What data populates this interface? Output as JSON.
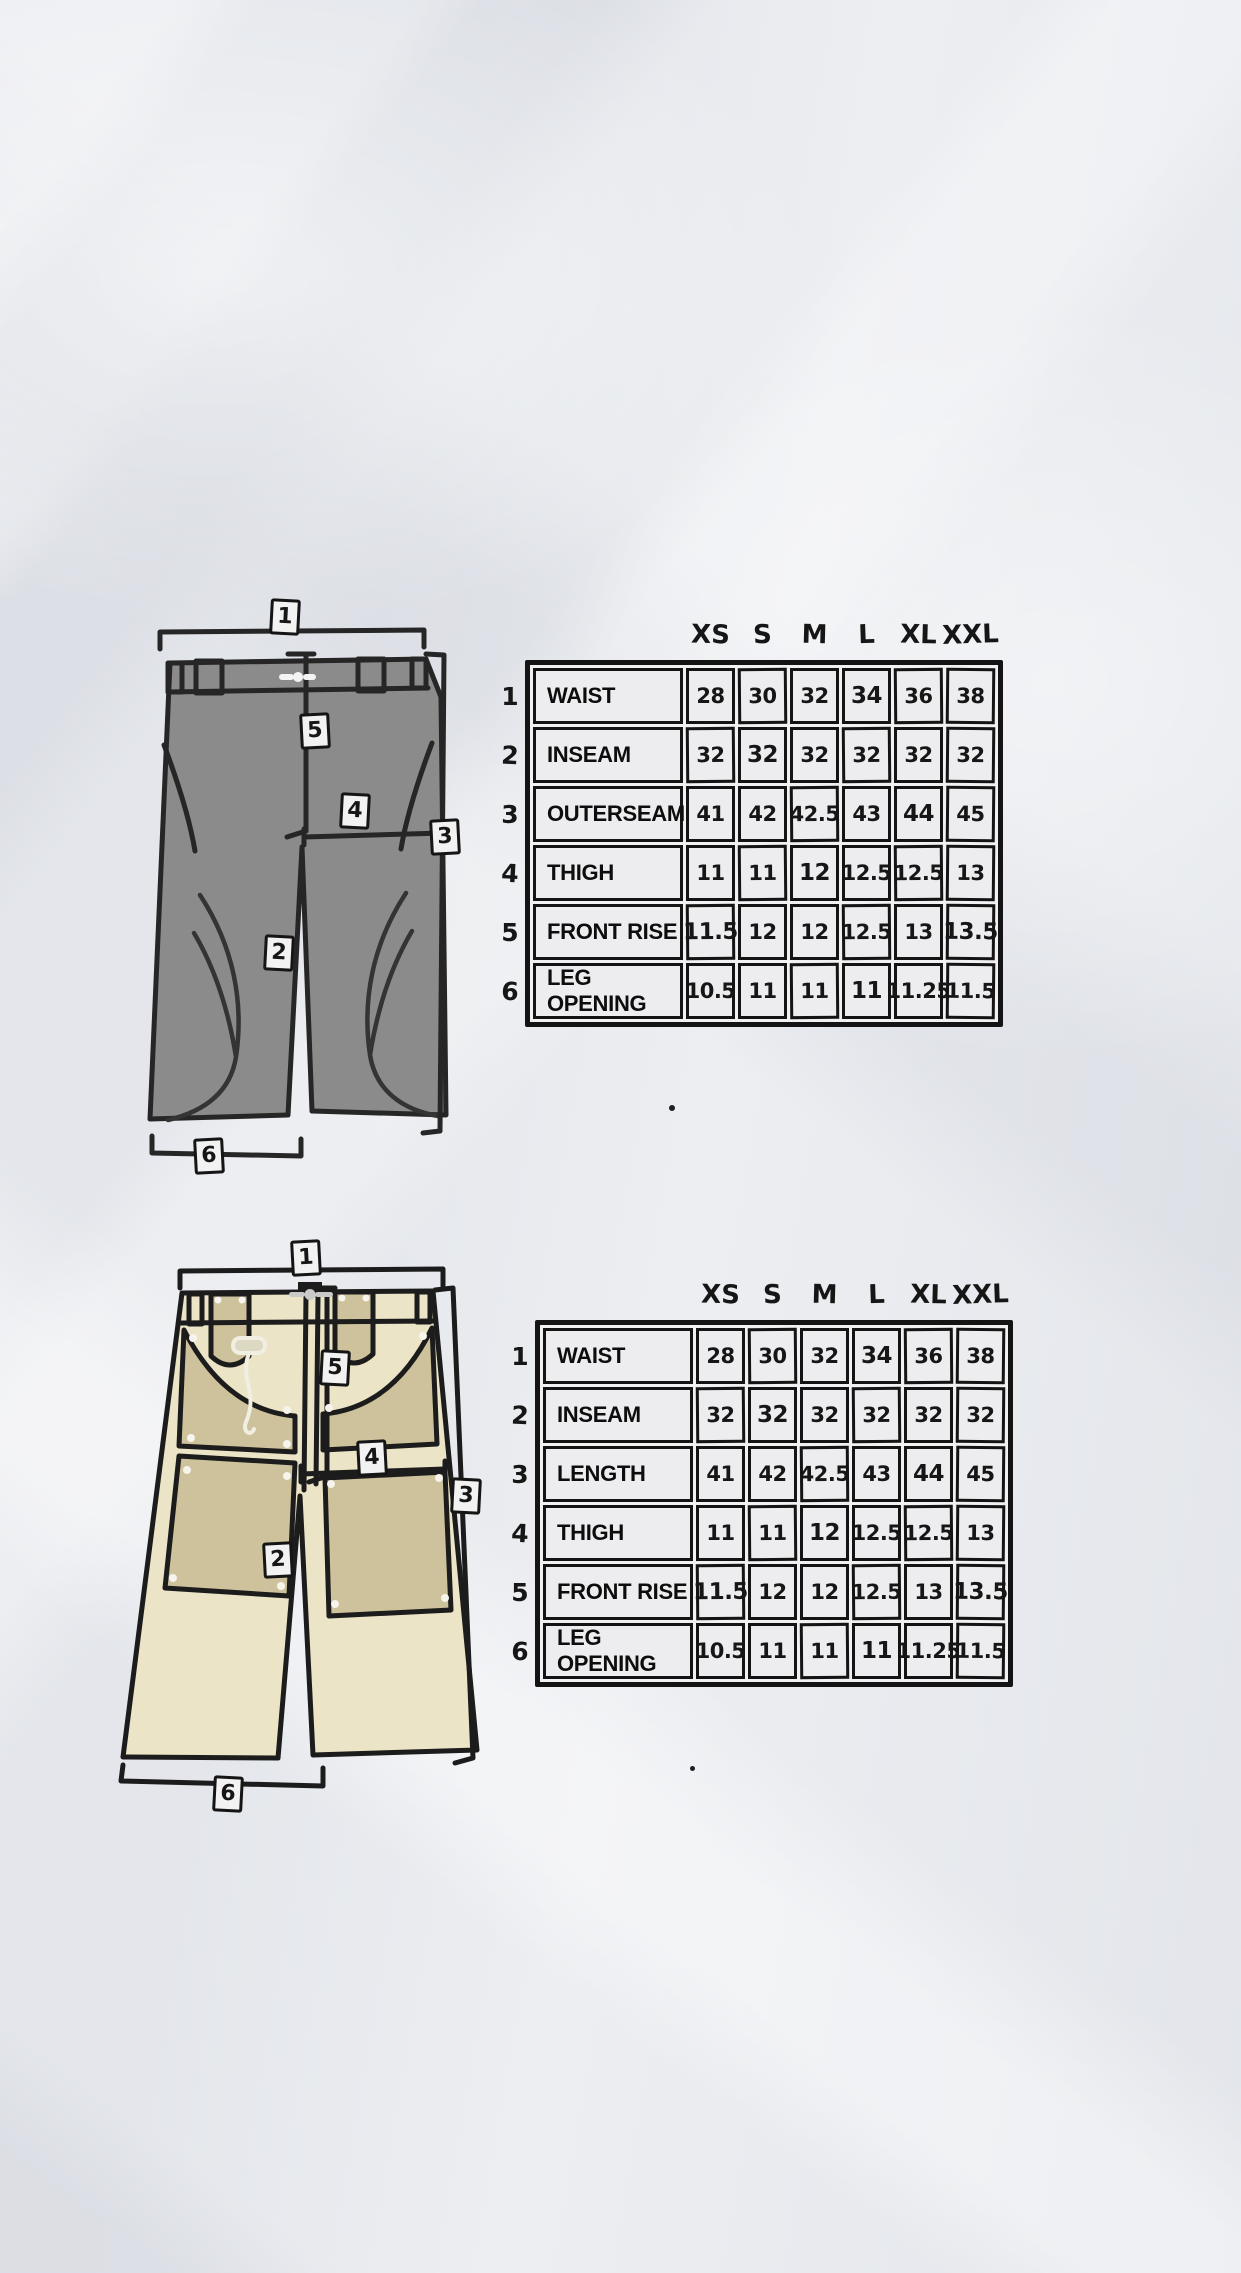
{
  "sizes": [
    "XS",
    "S",
    "M",
    "L",
    "XL",
    "XXL"
  ],
  "tables": [
    {
      "rows": [
        {
          "num": "1",
          "label": "WAIST",
          "values": [
            "28",
            "30",
            "32",
            "34",
            "36",
            "38"
          ]
        },
        {
          "num": "2",
          "label": "INSEAM",
          "values": [
            "32",
            "32",
            "32",
            "32",
            "32",
            "32"
          ]
        },
        {
          "num": "3",
          "label": "OUTERSEAM",
          "values": [
            "41",
            "42",
            "42.5",
            "43",
            "44",
            "45"
          ]
        },
        {
          "num": "4",
          "label": "THIGH",
          "values": [
            "11",
            "11",
            "12",
            "12.5",
            "12.5",
            "13"
          ]
        },
        {
          "num": "5",
          "label": "FRONT RISE",
          "values": [
            "11.5",
            "12",
            "12",
            "12.5",
            "13",
            "13.5"
          ]
        },
        {
          "num": "6",
          "label": "LEG OPENING",
          "values": [
            "10.5",
            "11",
            "11",
            "11",
            "11.25",
            "11.5"
          ]
        }
      ]
    },
    {
      "rows": [
        {
          "num": "1",
          "label": "WAIST",
          "values": [
            "28",
            "30",
            "32",
            "34",
            "36",
            "38"
          ]
        },
        {
          "num": "2",
          "label": "INSEAM",
          "values": [
            "32",
            "32",
            "32",
            "32",
            "32",
            "32"
          ]
        },
        {
          "num": "3",
          "label": "LENGTH",
          "values": [
            "41",
            "42",
            "42.5",
            "43",
            "44",
            "45"
          ]
        },
        {
          "num": "4",
          "label": "THIGH",
          "values": [
            "11",
            "11",
            "12",
            "12.5",
            "12.5",
            "13"
          ]
        },
        {
          "num": "5",
          "label": "FRONT RISE",
          "values": [
            "11.5",
            "12",
            "12",
            "12.5",
            "13",
            "13.5"
          ]
        },
        {
          "num": "6",
          "label": "LEG OPENING",
          "values": [
            "10.5",
            "11",
            "11",
            "11",
            "11.25",
            "11.5"
          ]
        }
      ]
    }
  ],
  "diagrams": [
    {
      "name": "gray-baggy-pants",
      "markers": [
        "1",
        "2",
        "3",
        "4",
        "5",
        "6"
      ],
      "colors": {
        "body": "#8b8b8b",
        "outline": "#262626"
      }
    },
    {
      "name": "khaki-cargo-pants",
      "markers": [
        "1",
        "2",
        "3",
        "4",
        "5",
        "6"
      ],
      "colors": {
        "body": "#ebe4c6",
        "pocket": "#cdc29b",
        "outline": "#1c1c1c",
        "rivet": "#f6f4ec"
      }
    }
  ],
  "chart_data": [
    {
      "type": "table",
      "columns": [
        "XS",
        "S",
        "M",
        "L",
        "XL",
        "XXL"
      ],
      "rows": [
        [
          "WAIST",
          28,
          30,
          32,
          34,
          36,
          38
        ],
        [
          "INSEAM",
          32,
          32,
          32,
          32,
          32,
          32
        ],
        [
          "OUTERSEAM",
          41,
          42,
          42.5,
          43,
          44,
          45
        ],
        [
          "THIGH",
          11,
          11,
          12,
          12.5,
          12.5,
          13
        ],
        [
          "FRONT RISE",
          11.5,
          12,
          12,
          12.5,
          13,
          13.5
        ],
        [
          "LEG OPENING",
          10.5,
          11,
          11,
          11,
          11.25,
          11.5
        ]
      ]
    },
    {
      "type": "table",
      "columns": [
        "XS",
        "S",
        "M",
        "L",
        "XL",
        "XXL"
      ],
      "rows": [
        [
          "WAIST",
          28,
          30,
          32,
          34,
          36,
          38
        ],
        [
          "INSEAM",
          32,
          32,
          32,
          32,
          32,
          32
        ],
        [
          "LENGTH",
          41,
          42,
          42.5,
          43,
          44,
          45
        ],
        [
          "THIGH",
          11,
          11,
          12,
          12.5,
          12.5,
          13
        ],
        [
          "FRONT RISE",
          11.5,
          12,
          12,
          12.5,
          13,
          13.5
        ],
        [
          "LEG OPENING",
          10.5,
          11,
          11,
          11,
          11.25,
          11.5
        ]
      ]
    }
  ]
}
